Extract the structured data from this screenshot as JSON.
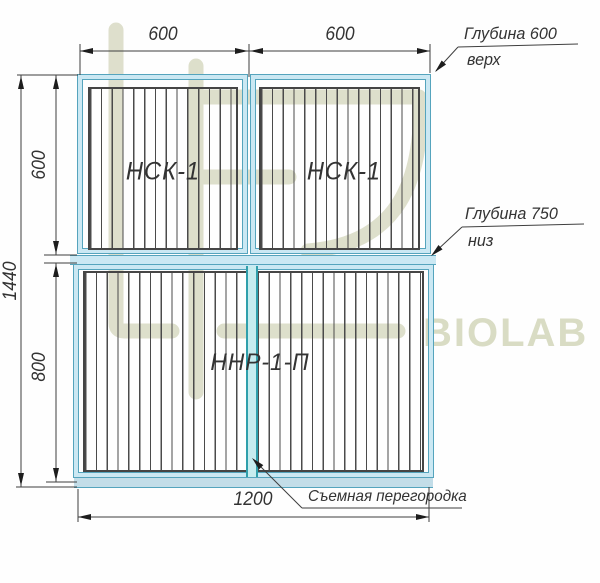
{
  "drawing": {
    "title_hint": "lab furniture front-view drawing",
    "cabinets": [
      {
        "id": "upper-left",
        "label": "НСК-1"
      },
      {
        "id": "upper-right",
        "label": "НСК-1"
      },
      {
        "id": "lower",
        "label": "ННР-1-П"
      }
    ],
    "dimensions": {
      "top_left": "600",
      "top_right": "600",
      "left_upper": "600",
      "left_lower": "800",
      "left_total": "1440",
      "bottom": "1200"
    },
    "annotations": {
      "depth_top_line1": "Глубина 600",
      "depth_top_line2": "верх",
      "depth_bottom_line1": "Глубина 750",
      "depth_bottom_line2": "низ",
      "partition": "Съемная перегородка"
    },
    "colors": {
      "outline_cyan": "#55a4bd",
      "fill_cyan": "#cbe8f3",
      "partition_teal": "#2f9fab",
      "line_dark": "#3f3f3f",
      "watermark_olive": "#d9dcc4"
    }
  },
  "watermark": {
    "text": "BIOLAB"
  }
}
